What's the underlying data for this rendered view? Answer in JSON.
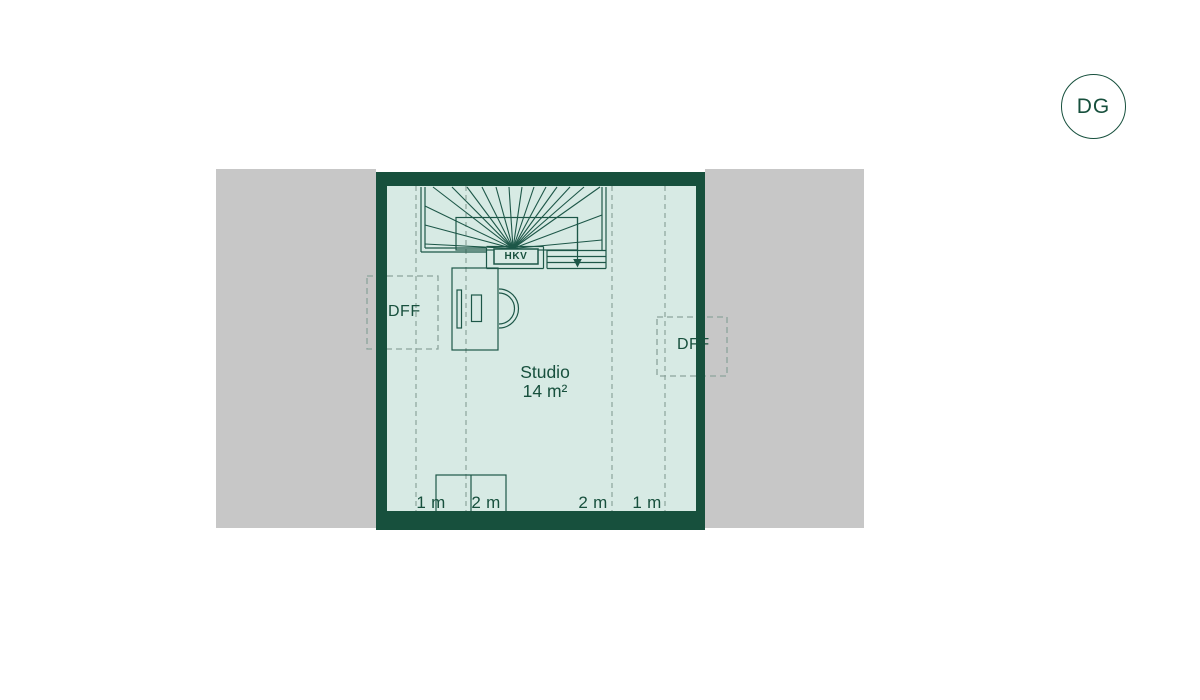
{
  "title": "Floor plan attic level",
  "level_badge": {
    "label": "DG"
  },
  "room": {
    "name": "Studio",
    "area": "14 m²"
  },
  "labels": {
    "hkv": "HKV",
    "dff_left": "DFF",
    "dff_right": "DFF"
  },
  "measurements": [
    {
      "label": "1 m",
      "x": 431
    },
    {
      "label": "2 m",
      "x": 486
    },
    {
      "label": "2 m",
      "x": 593
    },
    {
      "label": "1 m",
      "x": 647
    }
  ],
  "colors": {
    "wall": "#17503d",
    "line": "#1d5748",
    "floor": "#d7eae4",
    "roof": "#c7c7c7",
    "dash": "#8ba49c",
    "text": "#17503d",
    "page": "#ffffff"
  },
  "positions": {
    "badge": {
      "left": 1061,
      "top": 74,
      "size": 63
    },
    "dff_left_label": {
      "left": 388,
      "top": 303
    },
    "dff_right_label": {
      "left": 677,
      "top": 336
    },
    "studio_label": {
      "left": 465,
      "top": 363,
      "width": 160
    },
    "hkv_label": {
      "left": 494,
      "top": 249,
      "width": 44,
      "height": 15
    },
    "measure_top": 493
  },
  "plan": {
    "roof_left": {
      "x": 216,
      "y": 169,
      "w": 160,
      "h": 359
    },
    "roof_right": {
      "x": 705,
      "y": 169,
      "w": 159,
      "h": 359
    },
    "building": {
      "x": 376,
      "y": 172,
      "w": 329,
      "h": 358,
      "wall": {
        "top": 14,
        "right": 9,
        "bottom": 19,
        "left": 11
      }
    },
    "floor": {
      "x": 387,
      "y": 186,
      "w": 309,
      "h": 325
    },
    "height_lines": {
      "x": [
        416,
        466,
        612,
        665
      ],
      "y1": 186,
      "y2": 511
    },
    "stair": {
      "lines": [
        [
          421,
          187,
          421,
          252
        ],
        [
          425,
          187,
          425,
          248
        ],
        [
          421,
          252,
          486.5,
          252
        ],
        [
          425,
          248,
          486.5,
          248
        ],
        [
          486.5,
          248,
          486.5,
          268.5
        ],
        [
          486.5,
          246.5,
          543.5,
          246.5
        ],
        [
          543.5,
          246.5,
          543.5,
          268.5
        ],
        [
          486.5,
          268.5,
          543.5,
          268.5
        ],
        [
          547,
          250.5,
          547,
          268.5
        ],
        [
          547,
          250.5,
          606,
          250.5
        ],
        [
          547,
          256.5,
          606,
          256.5
        ],
        [
          547,
          262.5,
          606,
          262.5
        ],
        [
          547,
          268.5,
          606,
          268.5
        ],
        [
          606,
          187,
          606,
          268.5
        ],
        [
          602,
          187,
          602,
          250.5
        ]
      ],
      "fan_center": [
        513,
        248.5
      ],
      "fan_top_x": [
        433,
        452,
        467,
        482,
        496,
        509,
        522,
        534,
        546,
        557,
        570,
        584,
        600
      ],
      "fan_top_y": 187,
      "fan_left_x": 425,
      "fan_left_y": [
        206,
        225,
        244
      ],
      "fan_right_x": 602,
      "fan_right_y": [
        215,
        240
      ],
      "opening": {
        "x": 456,
        "y": 217.5,
        "w": 121.5,
        "h": 32.5
      },
      "walk_line": {
        "x": 577.5,
        "y1": 217.5,
        "y2": 261
      },
      "arrow": [
        [
          573.2,
          259
        ],
        [
          581.8,
          259
        ],
        [
          577.5,
          267.5
        ]
      ],
      "hkv_box": {
        "x": 494,
        "y": 249,
        "w": 44,
        "h": 15
      }
    },
    "desk": {
      "rects": [
        [
          452,
          268,
          46,
          82
        ],
        [
          457,
          290,
          4.5,
          38
        ],
        [
          471.5,
          295,
          10,
          26.5
        ]
      ],
      "chair_arcs": [
        {
          "cx": 499,
          "cy": 308.5,
          "r": 19.5
        },
        {
          "cx": 499,
          "cy": 308.5,
          "r": 15.5
        }
      ]
    },
    "sideboard": {
      "rect": [
        436,
        475,
        70,
        37
      ],
      "divider": [
        471,
        475,
        471,
        512
      ]
    },
    "dff_left_box": {
      "x": 367,
      "y": 276,
      "w": 71,
      "h": 73
    },
    "dff_right_box": {
      "x": 657,
      "y": 317,
      "w": 70,
      "h": 59
    }
  }
}
